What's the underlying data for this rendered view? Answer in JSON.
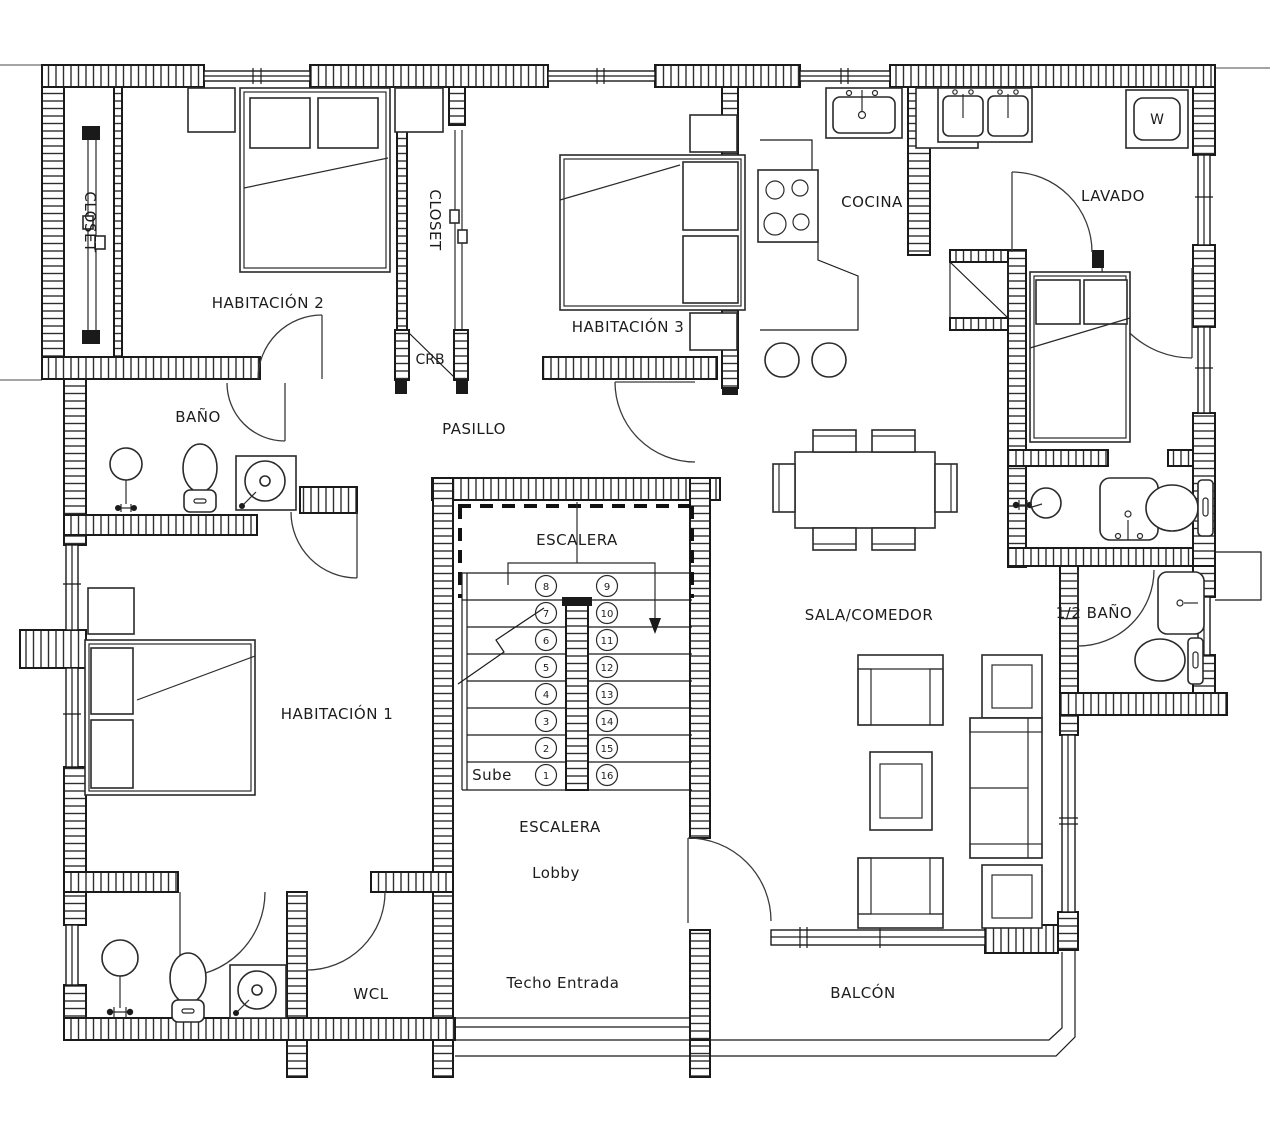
{
  "plan": {
    "rooms": {
      "closet1": "CLOSET",
      "habitacion2": "HABITACIÓN 2",
      "closet2": "CLOSET",
      "crb": "CRB",
      "habitacion3": "HABITACIÓN 3",
      "cocina": "COCINA",
      "lavado": "LAVADO",
      "bano": "BAÑO",
      "pasillo": "PASILLO",
      "escalera_sup": "ESCALERA",
      "sube": "Sube",
      "escalera_inf": "ESCALERA",
      "lobby": "Lobby",
      "sala_comedor": "SALA/COMEDOR",
      "medio_bano": "1/2 BAÑO",
      "habitacion1": "HABITACIÓN 1",
      "wcl": "WCL",
      "techo_entrada": "Techo Entrada",
      "balcon": "BALCÓN"
    },
    "appliances": {
      "washer": "W"
    },
    "stairs": {
      "steps": [
        "1",
        "2",
        "3",
        "4",
        "5",
        "6",
        "7",
        "8",
        "9",
        "10",
        "11",
        "12",
        "13",
        "14",
        "15",
        "16"
      ]
    },
    "colors": {
      "ink": "#1a1a1a",
      "hatch": "#2f2f2f",
      "background": "#ffffff"
    }
  }
}
